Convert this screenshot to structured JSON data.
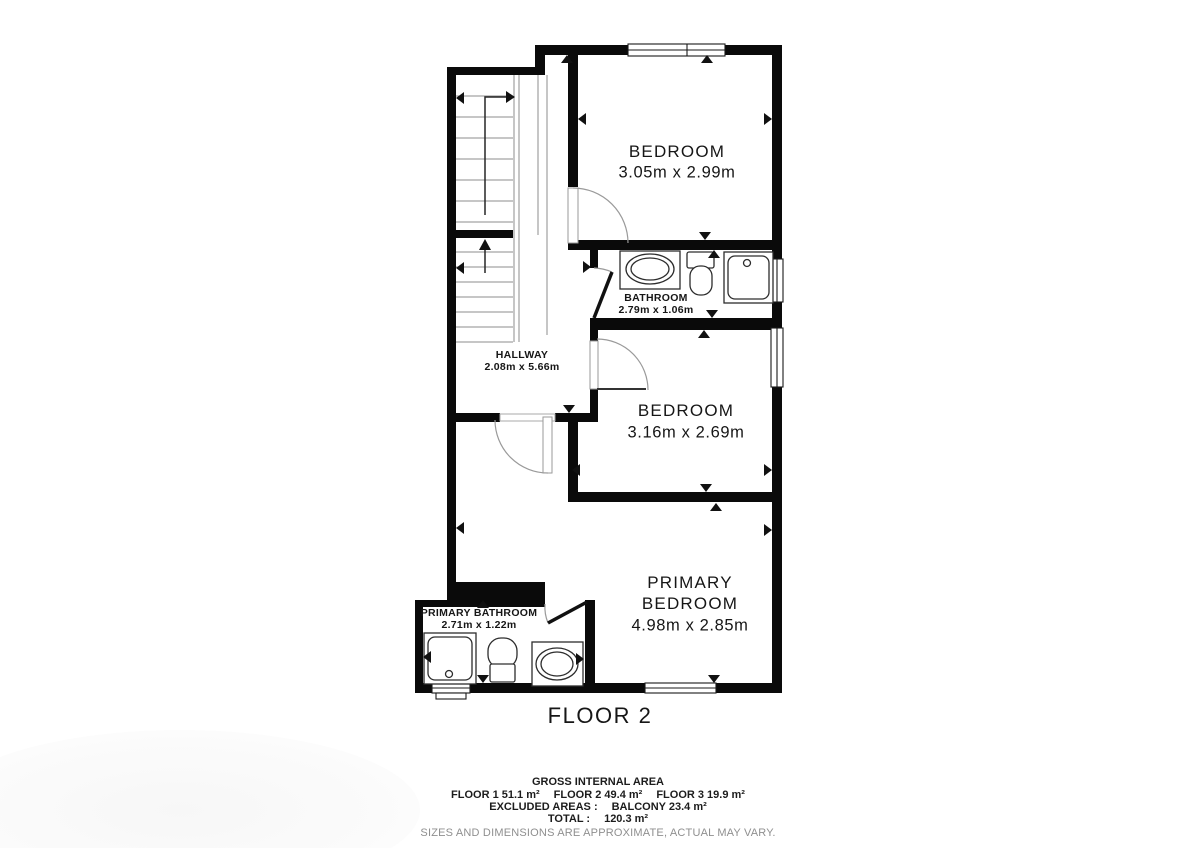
{
  "plan": {
    "floor_title": "FLOOR 2",
    "rooms": {
      "bedroom_top": {
        "name": "BEDROOM",
        "dims": "3.05m x 2.99m"
      },
      "bathroom": {
        "name": "BATHROOM",
        "dims": "2.79m x 1.06m"
      },
      "hallway": {
        "name": "HALLWAY",
        "dims": "2.08m x 5.66m"
      },
      "bedroom_mid": {
        "name": "BEDROOM",
        "dims": "3.16m x 2.69m"
      },
      "primary_bedroom": {
        "name": "PRIMARY BEDROOM",
        "dims": "4.98m x 2.85m"
      },
      "primary_bathroom": {
        "name": "PRIMARY BATHROOM",
        "dims": "2.71m x 1.22m"
      }
    }
  },
  "footer": {
    "gross_title": "GROSS INTERNAL AREA",
    "floor_areas": [
      "FLOOR 1 51.1 m²",
      "FLOOR 2 49.4 m²",
      "FLOOR 3 19.9 m²"
    ],
    "excluded_label": "EXCLUDED AREAS :",
    "excluded_value": "BALCONY 23.4 m²",
    "total_label": "TOTAL :",
    "total_value": "120.3 m²",
    "disclaimer": "SIZES AND DIMENSIONS ARE APPROXIMATE, ACTUAL MAY VARY."
  },
  "colors": {
    "wall": "#0a0a0a",
    "text": "#161616",
    "muted": "#8f8f8f"
  }
}
